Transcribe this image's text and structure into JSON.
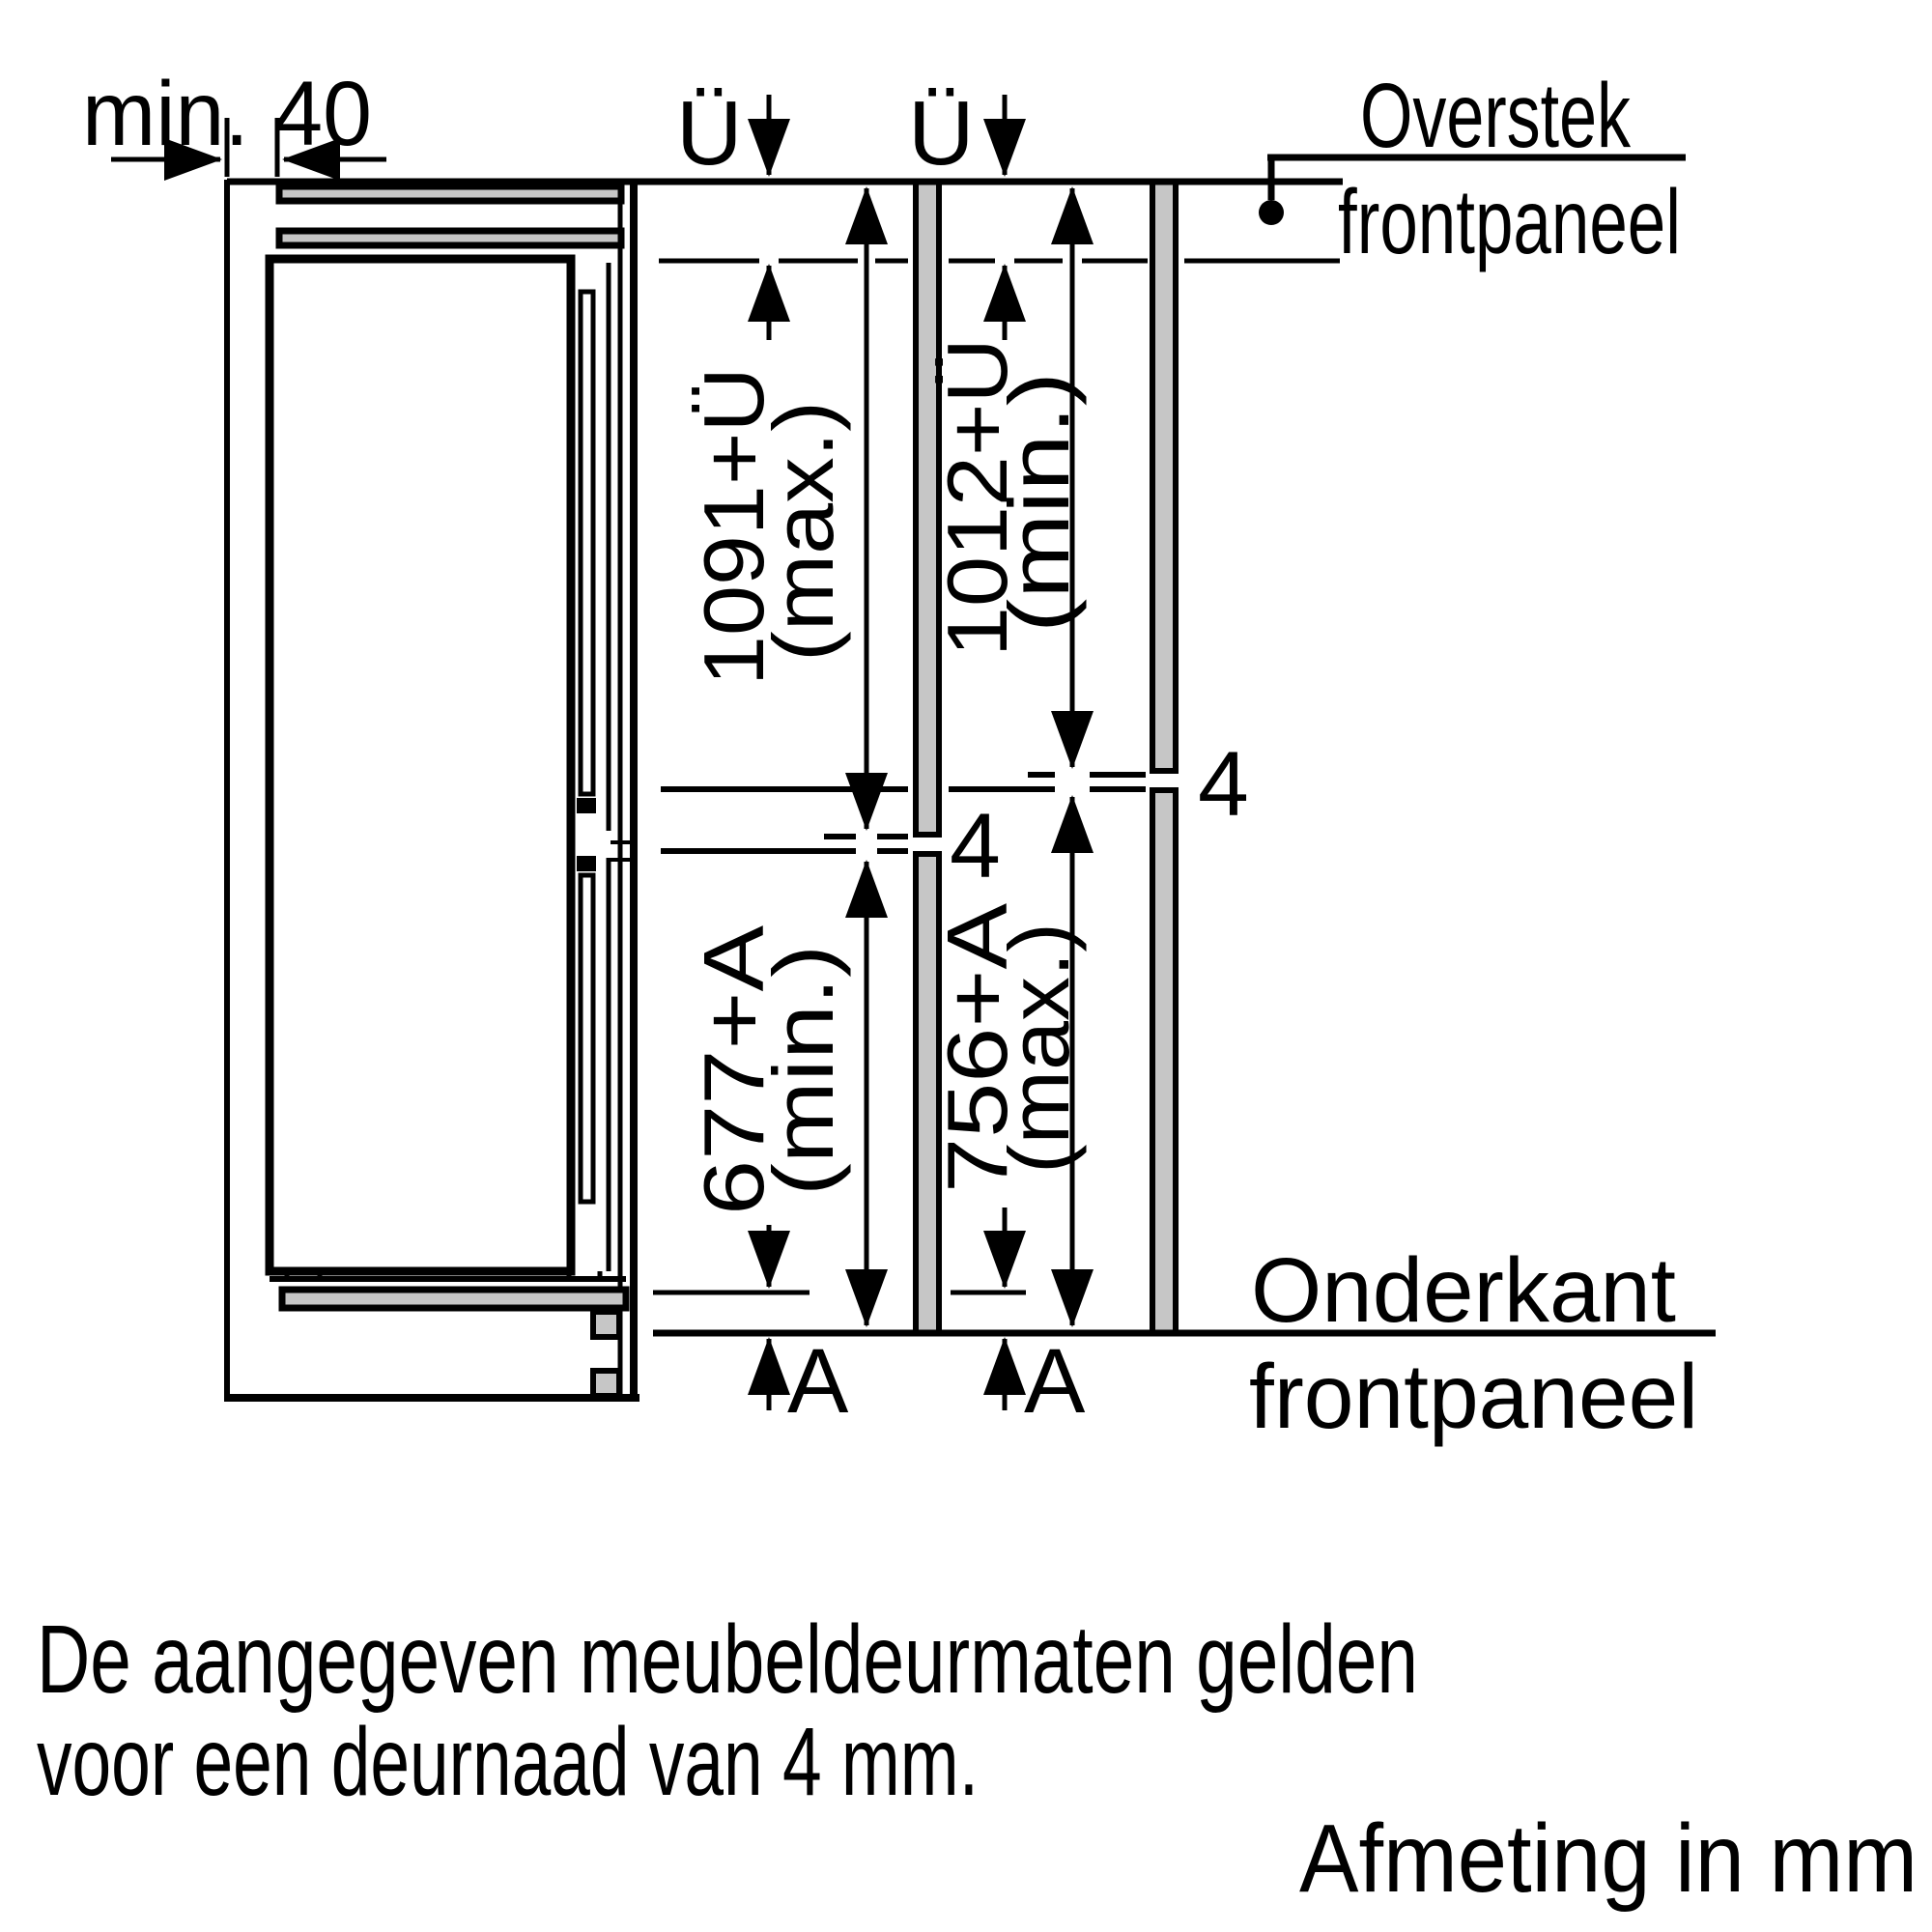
{
  "diagram": {
    "min_gap_label": "min. 40",
    "overhang": {
      "symbol_left": "Ü",
      "symbol_right": "Ü"
    },
    "top_leader": {
      "line1": "Overstek",
      "line2": "frontpaneel"
    },
    "bottom_leader": {
      "line1": "Onderkant",
      "line2": "frontpaneel"
    },
    "left_column": {
      "upper": "1091+Ü",
      "upper_note": "(max.)",
      "lower": "677+A",
      "lower_note": "(min.)",
      "joint_gap": "4",
      "bottom_letter": "A"
    },
    "right_column": {
      "upper": "1012+Ü",
      "upper_note": "(min.)",
      "lower": "756+A",
      "lower_note": "(max.)",
      "joint_gap": "4",
      "bottom_letter": "A"
    },
    "colors": {
      "panel_fill": "#c6c6c6",
      "ink": "#000000"
    }
  },
  "caption": {
    "line1": "De aangegeven meubeldeurmaten gelden",
    "line2": "voor een deurnaad van 4 mm."
  },
  "footer": {
    "note": "Afmeting in mm"
  }
}
